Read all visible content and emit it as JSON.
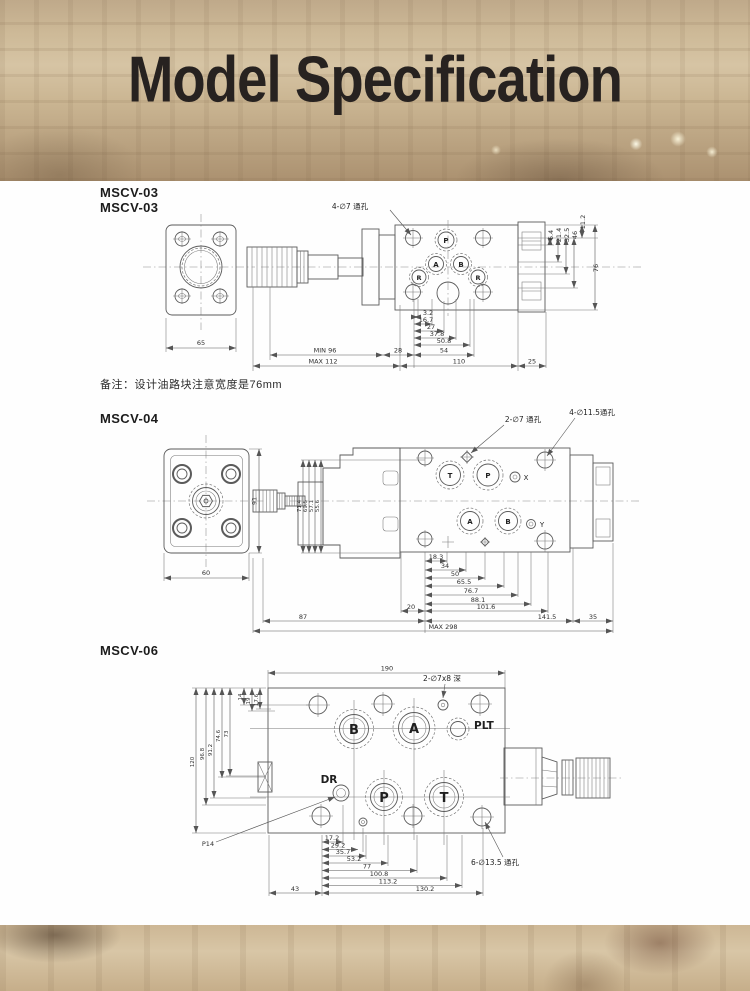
{
  "header": {
    "title": "Model Specification"
  },
  "note": "备注：设计油路块注意宽度是76mm",
  "mscv03": {
    "title1": "MSCV-03",
    "title2": "MSCV-03",
    "callout_holes": "4-∅7 通孔",
    "ports": {
      "p": "P",
      "a": "A",
      "b": "B",
      "r_left": "R",
      "r_right": "R"
    },
    "dims": {
      "flange_width": "65",
      "stack": [
        "3.2",
        "16.7",
        "27",
        "37.8",
        "50.8",
        "54"
      ],
      "min_width": "MIN 96",
      "d28": "28",
      "max_width": "MAX 112",
      "d110": "110",
      "d25": "25",
      "vert": [
        "6.4",
        "21.4",
        "32.5",
        "46",
        "11.2",
        "76"
      ]
    }
  },
  "mscv04": {
    "title": "MSCV-04",
    "callout_holes_small": "2-∅7 通孔",
    "callout_holes_large": "4-∅11.5通孔",
    "ports": {
      "t": "T",
      "p": "P",
      "x": "X",
      "a": "A",
      "b": "B",
      "y": "Y"
    },
    "dims": {
      "flange_width": "60",
      "flange_height": "91",
      "side_stack": [
        "71.4",
        "69.5",
        "57.1",
        "55.6"
      ],
      "stack": [
        "18.3",
        "34",
        "50",
        "65.5",
        "76.7",
        "88.1",
        "101.6"
      ],
      "d20": "20",
      "d87": "87",
      "d141": "141.5",
      "d35": "35",
      "max_length": "MAX 298"
    }
  },
  "mscv06": {
    "title": "MSCV-06",
    "callout_holes_small": "2-∅7x8 深",
    "callout_holes_large": "6-∅13.5 通孔",
    "p14_label": "P14",
    "ports": {
      "b": "B",
      "a": "A",
      "plt": "PLT",
      "dr": "DR",
      "p": "P",
      "t": "T"
    },
    "dims": {
      "top_width": "190",
      "left": [
        "14",
        "19",
        "17.6",
        "73",
        "74.6",
        "91.2",
        "96.8",
        "120"
      ],
      "stack": [
        "17.2",
        "29.2",
        "35.7",
        "53.2",
        "77",
        "100.8",
        "113.2"
      ],
      "d43": "43",
      "d130": "130.2"
    }
  }
}
